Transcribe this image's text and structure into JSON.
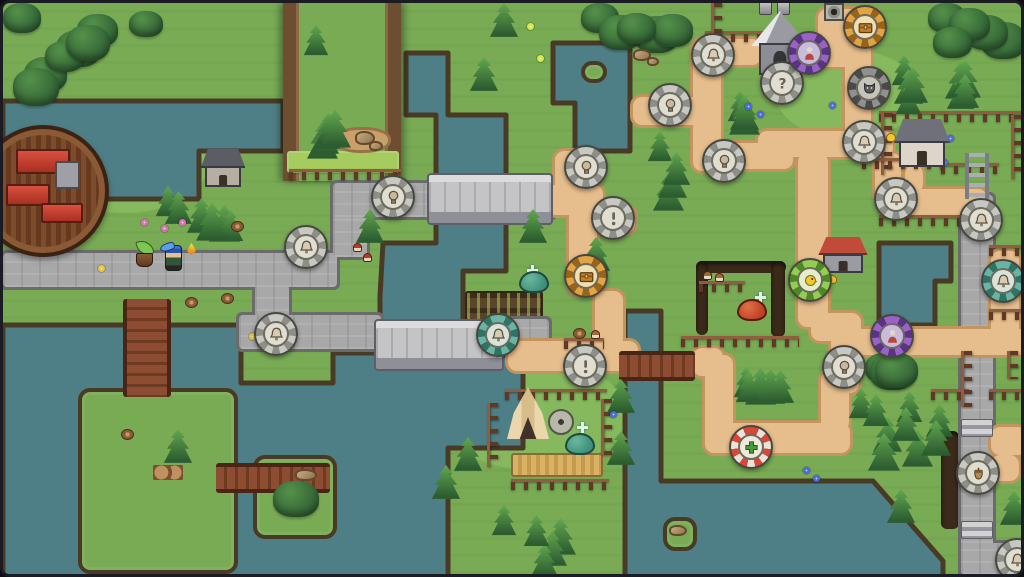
{
  "meta": {
    "width": 1024,
    "height": 577
  },
  "palette": {
    "frame": "#1b1b24",
    "grass": "#79ab55",
    "grass_light": "#86b95e",
    "grass_bright": "#a6cb5e",
    "water": "#4f7f86",
    "cliff": "#493a26",
    "road_fill": "#a8a8a8",
    "road_edge": "#6b6b6b",
    "path_fill": "#e6bd8c",
    "path_edge": "#c2945e",
    "marker_rings": {
      "gray": [
        "#c8c8c2",
        "#8e8e88",
        "#e0ddd1"
      ],
      "orange": [
        "#e2a342",
        "#9a6418",
        "#f0e0b0"
      ],
      "purple": [
        "#9a62c8",
        "#5a3484",
        "#cabade"
      ],
      "teal": [
        "#6ab4a4",
        "#2e7464",
        "#d8e4da"
      ],
      "green": [
        "#94cc54",
        "#4e8a24",
        "#e4eec8"
      ],
      "redwhite": [
        "#d84838",
        "#e8e4da",
        "#efe9dc"
      ],
      "dark": [
        "#909090",
        "#4a4a4a",
        "#c4c4ba"
      ]
    },
    "slime": {
      "teal": [
        "#3f8f7c",
        "#6ab89e",
        "#1e4a40"
      ],
      "red": [
        "#c04024",
        "#e07048",
        "#5a1a0c"
      ]
    }
  },
  "water": [
    {
      "name": "northwest-lake",
      "points": [
        [
          0,
          98
        ],
        [
          280,
          98
        ],
        [
          280,
          148
        ],
        [
          196,
          148
        ],
        [
          196,
          196
        ],
        [
          0,
          196
        ]
      ]
    },
    {
      "name": "central-river-and-south-lake",
      "points": [
        [
          403,
          50
        ],
        [
          445,
          50
        ],
        [
          445,
          112
        ],
        [
          503,
          112
        ],
        [
          503,
          268
        ],
        [
          460,
          268
        ],
        [
          460,
          352
        ],
        [
          520,
          352
        ],
        [
          520,
          445
        ],
        [
          445,
          445
        ],
        [
          445,
          577
        ],
        [
          0,
          577
        ],
        [
          0,
          322
        ],
        [
          238,
          322
        ],
        [
          238,
          380
        ],
        [
          330,
          380
        ],
        [
          330,
          350
        ],
        [
          377,
          350
        ],
        [
          377,
          293
        ],
        [
          380,
          240
        ],
        [
          433,
          240
        ],
        [
          433,
          112
        ],
        [
          403,
          112
        ]
      ]
    },
    {
      "name": "forest-pond",
      "points": [
        [
          550,
          40
        ],
        [
          627,
          40
        ],
        [
          627,
          148
        ],
        [
          572,
          148
        ],
        [
          572,
          100
        ],
        [
          550,
          100
        ]
      ]
    },
    {
      "name": "east-pond",
      "points": [
        [
          876,
          240
        ],
        [
          948,
          240
        ],
        [
          948,
          278
        ],
        [
          932,
          278
        ],
        [
          932,
          322
        ],
        [
          876,
          322
        ]
      ]
    },
    {
      "name": "south-river-and-sea",
      "points": [
        [
          622,
          308
        ],
        [
          658,
          308
        ],
        [
          658,
          478
        ],
        [
          870,
          478
        ],
        [
          940,
          558
        ],
        [
          940,
          577
        ],
        [
          622,
          577
        ]
      ]
    }
  ],
  "islands": [
    {
      "x": 75,
      "y": 385,
      "w": 160,
      "h": 186
    },
    {
      "x": 250,
      "y": 452,
      "w": 84,
      "h": 84
    },
    {
      "x": 578,
      "y": 58,
      "w": 26,
      "h": 22
    },
    {
      "x": 660,
      "y": 514,
      "w": 34,
      "h": 34
    }
  ],
  "plateau": {
    "x": 280,
    "y": 0,
    "w": 118,
    "h": 178
  },
  "roads": [
    [
      0,
      250,
      334,
      34
    ],
    [
      252,
      282,
      34,
      38
    ],
    [
      236,
      312,
      142,
      34
    ],
    [
      330,
      192,
      34,
      62
    ],
    [
      330,
      180,
      222,
      34
    ],
    [
      490,
      316,
      56,
      34
    ],
    [
      958,
      192,
      32,
      360
    ],
    [
      958,
      540,
      66,
      32
    ]
  ],
  "paths": [
    [
      544,
      182,
      56,
      30
    ],
    [
      552,
      148,
      30,
      58
    ],
    [
      630,
      94,
      72,
      28
    ],
    [
      690,
      36,
      28,
      132
    ],
    [
      690,
      140,
      100,
      26
    ],
    [
      755,
      128,
      135,
      26
    ],
    [
      872,
      150,
      26,
      50
    ],
    [
      902,
      162,
      18,
      28
    ],
    [
      884,
      186,
      100,
      26
    ],
    [
      694,
      36,
      64,
      26
    ],
    [
      798,
      36,
      66,
      28
    ],
    [
      766,
      66,
      26,
      30
    ],
    [
      842,
      40,
      26,
      104
    ],
    [
      815,
      6,
      62,
      34
    ],
    [
      566,
      200,
      28,
      92
    ],
    [
      588,
      204,
      44,
      26
    ],
    [
      592,
      288,
      28,
      56
    ],
    [
      505,
      338,
      130,
      30
    ],
    [
      690,
      345,
      30,
      28
    ],
    [
      702,
      352,
      28,
      86
    ],
    [
      702,
      420,
      145,
      30
    ],
    [
      818,
      368,
      28,
      60
    ],
    [
      795,
      150,
      30,
      174
    ],
    [
      808,
      310,
      50,
      28
    ],
    [
      828,
      330,
      28,
      60
    ],
    [
      850,
      326,
      174,
      26
    ],
    [
      988,
      248,
      28,
      100
    ],
    [
      988,
      424,
      36,
      28
    ],
    [
      988,
      452,
      28,
      26
    ]
  ],
  "bridges": [
    {
      "type": "stone",
      "x": 424,
      "y": 170,
      "w": 126,
      "h": 52
    },
    {
      "type": "stone",
      "x": 371,
      "y": 316,
      "w": 130,
      "h": 52
    },
    {
      "type": "wood-v",
      "x": 120,
      "y": 296,
      "w": 48,
      "h": 98
    },
    {
      "type": "wood-h",
      "x": 213,
      "y": 460,
      "w": 114,
      "h": 30
    },
    {
      "type": "wood-h",
      "x": 616,
      "y": 348,
      "w": 76,
      "h": 30
    }
  ],
  "fields": [
    {
      "type": "crops",
      "x": 462,
      "y": 288,
      "w": 78,
      "h": 30
    },
    {
      "type": "wheat",
      "x": 508,
      "y": 450,
      "w": 92,
      "h": 24
    },
    {
      "type": "meadow",
      "x": 284,
      "y": 148,
      "w": 112,
      "h": 22
    },
    {
      "type": "dirt",
      "x": 330,
      "y": 124,
      "w": 58,
      "h": 26
    }
  ],
  "fences": [
    [
      286,
      166,
      112,
      "h"
    ],
    [
      702,
      28,
      62,
      "h"
    ],
    [
      708,
      0,
      34,
      "v"
    ],
    [
      876,
      108,
      146,
      "h"
    ],
    [
      878,
      110,
      62,
      "v"
    ],
    [
      938,
      160,
      58,
      "h"
    ],
    [
      1008,
      112,
      64,
      "v"
    ],
    [
      859,
      155,
      80,
      "h"
    ],
    [
      876,
      212,
      116,
      "h"
    ],
    [
      696,
      278,
      46,
      "h"
    ],
    [
      678,
      333,
      118,
      "h"
    ],
    [
      561,
      335,
      40,
      "h"
    ],
    [
      928,
      386,
      38,
      "h"
    ],
    [
      986,
      386,
      38,
      "h"
    ],
    [
      986,
      242,
      38,
      "h"
    ],
    [
      986,
      306,
      38,
      "h"
    ],
    [
      958,
      348,
      56,
      "v"
    ],
    [
      1004,
      348,
      28,
      "v"
    ],
    [
      502,
      386,
      102,
      "h"
    ],
    [
      484,
      400,
      64,
      "v"
    ],
    [
      598,
      396,
      56,
      "v"
    ],
    [
      508,
      476,
      98,
      "h"
    ]
  ],
  "trenches": [
    [
      693,
      258,
      90,
      12
    ],
    [
      693,
      258,
      12,
      74
    ],
    [
      768,
      258,
      14,
      76
    ],
    [
      938,
      428,
      18,
      98
    ]
  ],
  "forests": [
    {
      "kind": "bush",
      "x": 0,
      "y": 0,
      "w": 115,
      "h": 100,
      "n": 7
    },
    {
      "kind": "bush",
      "x": 578,
      "y": 0,
      "w": 118,
      "h": 44,
      "n": 5
    },
    {
      "kind": "bush",
      "x": 925,
      "y": 0,
      "w": 99,
      "h": 56,
      "n": 5
    },
    {
      "kind": "pine",
      "x": 888,
      "y": 52,
      "w": 134,
      "h": 60,
      "n": 8
    },
    {
      "kind": "pine",
      "x": 644,
      "y": 128,
      "w": 46,
      "h": 84,
      "n": 4
    },
    {
      "kind": "pine",
      "x": 724,
      "y": 88,
      "w": 56,
      "h": 40,
      "n": 3
    },
    {
      "kind": "pine",
      "x": 152,
      "y": 183,
      "w": 105,
      "h": 56,
      "n": 6
    },
    {
      "kind": "pine",
      "x": 300,
      "y": 22,
      "w": 80,
      "h": 130,
      "n": 6
    },
    {
      "kind": "pine",
      "x": 845,
      "y": 385,
      "w": 112,
      "h": 85,
      "n": 9
    },
    {
      "kind": "pine",
      "x": 730,
      "y": 364,
      "w": 72,
      "h": 54,
      "n": 5
    },
    {
      "kind": "pine",
      "x": 488,
      "y": 502,
      "w": 90,
      "h": 72,
      "n": 5
    },
    {
      "kind": "bush",
      "x": 862,
      "y": 350,
      "w": 54,
      "h": 24,
      "n": 3
    }
  ],
  "trees": [
    [
      578,
      234
    ],
    [
      515,
      206
    ],
    [
      352,
      206
    ],
    [
      466,
      54
    ],
    [
      486,
      0
    ],
    [
      603,
      376
    ],
    [
      603,
      428
    ],
    [
      883,
      486
    ],
    [
      996,
      488
    ],
    [
      450,
      434
    ],
    [
      428,
      462
    ],
    [
      160,
      426
    ]
  ],
  "bushes": [
    [
      126,
      8,
      34,
      26
    ],
    [
      270,
      478,
      46,
      36
    ]
  ],
  "buildings": [
    {
      "type": "walled-town",
      "x": -26,
      "y": 122,
      "w": 132,
      "h": 132
    },
    {
      "type": "house",
      "name": "stone-house",
      "x": 200,
      "y": 146,
      "w": 40,
      "h": 38,
      "roof": "#5c5c66",
      "wall": "#b6aea2"
    },
    {
      "type": "chapel",
      "x": 752,
      "y": 8,
      "w": 50,
      "h": 64
    },
    {
      "type": "house",
      "name": "farm-house",
      "x": 894,
      "y": 116,
      "w": 50,
      "h": 48,
      "roof": "#70707a",
      "wall": "#ddd5c9"
    },
    {
      "type": "house",
      "name": "red-roof-house",
      "x": 818,
      "y": 234,
      "w": 44,
      "h": 36,
      "roof": "#c14b38",
      "wall": "#9b9ba3"
    },
    {
      "type": "tent",
      "x": 504,
      "y": 384,
      "w": 42,
      "h": 52
    }
  ],
  "props": [
    {
      "type": "well",
      "x": 821,
      "y": 0
    },
    {
      "type": "statue",
      "x": 756,
      "y": -4
    },
    {
      "type": "statue",
      "x": 774,
      "y": -4
    },
    {
      "type": "millstone",
      "x": 545,
      "y": 406
    },
    {
      "type": "ladder",
      "x": 962,
      "y": 150
    },
    {
      "type": "stairs",
      "x": 958,
      "y": 416
    },
    {
      "type": "stairs",
      "x": 958,
      "y": 518
    },
    {
      "type": "logs",
      "x": 150,
      "y": 462
    },
    {
      "type": "rock",
      "x": 352,
      "y": 128,
      "w": 20,
      "h": 14
    },
    {
      "type": "rock",
      "x": 366,
      "y": 138,
      "w": 14,
      "h": 10
    },
    {
      "type": "rock",
      "x": 630,
      "y": 46,
      "w": 18,
      "h": 12
    },
    {
      "type": "rock",
      "x": 644,
      "y": 54,
      "w": 12,
      "h": 9
    },
    {
      "type": "rock",
      "x": 292,
      "y": 466,
      "w": 22,
      "h": 12
    },
    {
      "type": "rock",
      "x": 666,
      "y": 522,
      "w": 18,
      "h": 11
    },
    {
      "type": "stump",
      "x": 228,
      "y": 218
    },
    {
      "type": "stump",
      "x": 570,
      "y": 325
    },
    {
      "type": "stump",
      "x": 118,
      "y": 426
    },
    {
      "type": "stump",
      "x": 182,
      "y": 294
    },
    {
      "type": "stump",
      "x": 218,
      "y": 290
    },
    {
      "type": "mushroom",
      "x": 350,
      "y": 240,
      "color": "#c03828"
    },
    {
      "type": "mushroom",
      "x": 360,
      "y": 250,
      "color": "#c03828"
    },
    {
      "type": "mushroom",
      "x": 700,
      "y": 268,
      "color": "#a06a3a"
    },
    {
      "type": "mushroom",
      "x": 712,
      "y": 270,
      "color": "#a06a3a"
    },
    {
      "type": "mushroom",
      "x": 588,
      "y": 327,
      "color": "#a06a3a"
    },
    {
      "type": "flower",
      "x": 138,
      "y": 216,
      "color": "#e070b8"
    },
    {
      "type": "flower",
      "x": 158,
      "y": 222,
      "color": "#e070b8"
    },
    {
      "type": "flower",
      "x": 176,
      "y": 216,
      "color": "#e070b8"
    },
    {
      "type": "flower",
      "x": 95,
      "y": 262,
      "color": "#e8c83a"
    },
    {
      "type": "flower",
      "x": 246,
      "y": 330,
      "color": "#e8c83a"
    },
    {
      "type": "flower",
      "x": 524,
      "y": 20,
      "color": "#d8e84a"
    },
    {
      "type": "flower",
      "x": 534,
      "y": 52,
      "color": "#d8e84a"
    },
    {
      "type": "flower",
      "x": 944,
      "y": 132,
      "color": "#4a6ae0"
    },
    {
      "type": "flower",
      "x": 938,
      "y": 156,
      "color": "#4a6ae0"
    },
    {
      "type": "flower",
      "x": 742,
      "y": 100,
      "color": "#4a6ae0"
    },
    {
      "type": "flower",
      "x": 754,
      "y": 108,
      "color": "#4a6ae0"
    },
    {
      "type": "flower",
      "x": 826,
      "y": 99,
      "color": "#4a6ae0"
    },
    {
      "type": "flower",
      "x": 607,
      "y": 408,
      "color": "#4a6ae0"
    },
    {
      "type": "flower",
      "x": 800,
      "y": 464,
      "color": "#4a6ae0"
    },
    {
      "type": "flower",
      "x": 810,
      "y": 472,
      "color": "#4a6ae0"
    },
    {
      "type": "chick",
      "x": 883,
      "y": 130
    },
    {
      "type": "chick",
      "x": 824,
      "y": 272
    },
    {
      "type": "sparkle",
      "x": 524,
      "y": 262
    },
    {
      "type": "sparkle",
      "x": 752,
      "y": 289
    },
    {
      "type": "sparkle",
      "x": 574,
      "y": 419
    }
  ],
  "creatures": [
    {
      "kind": "slime",
      "color": "teal",
      "x": 516,
      "y": 268
    },
    {
      "kind": "slime",
      "color": "red",
      "x": 734,
      "y": 296
    },
    {
      "kind": "slime",
      "color": "teal",
      "x": 562,
      "y": 430
    }
  ],
  "characters": [
    {
      "type": "sprout-companion",
      "x": 132,
      "y": 240
    },
    {
      "type": "player",
      "x": 162,
      "y": 242
    },
    {
      "type": "flame",
      "x": 184,
      "y": 240
    }
  ],
  "markers": [
    {
      "x": 303,
      "y": 244,
      "ring": "gray",
      "icon": "bell-icon"
    },
    {
      "x": 273,
      "y": 331,
      "ring": "gray",
      "icon": "bell-icon"
    },
    {
      "x": 390,
      "y": 194,
      "ring": "gray",
      "icon": "bulb-icon"
    },
    {
      "x": 495,
      "y": 332,
      "ring": "teal",
      "icon": "bell-icon"
    },
    {
      "x": 583,
      "y": 164,
      "ring": "gray",
      "icon": "bulb-icon"
    },
    {
      "x": 583,
      "y": 273,
      "ring": "orange",
      "icon": "chest-icon"
    },
    {
      "x": 582,
      "y": 363,
      "ring": "gray",
      "icon": "exclamation-icon"
    },
    {
      "x": 610,
      "y": 215,
      "ring": "gray",
      "icon": "exclamation-icon"
    },
    {
      "x": 667,
      "y": 102,
      "ring": "gray",
      "icon": "bulb-icon"
    },
    {
      "x": 721,
      "y": 158,
      "ring": "gray",
      "icon": "bulb-icon"
    },
    {
      "x": 710,
      "y": 52,
      "ring": "gray",
      "icon": "bell-icon"
    },
    {
      "x": 779,
      "y": 80,
      "ring": "gray",
      "icon": "question-icon"
    },
    {
      "x": 806,
      "y": 50,
      "ring": "purple",
      "icon": "figure-icon"
    },
    {
      "x": 862,
      "y": 24,
      "ring": "orange",
      "icon": "chest-icon"
    },
    {
      "x": 866,
      "y": 85,
      "ring": "dark",
      "icon": "cat-icon"
    },
    {
      "x": 807,
      "y": 277,
      "ring": "green",
      "icon": "chick-icon"
    },
    {
      "x": 861,
      "y": 139,
      "ring": "gray",
      "icon": "bell-icon"
    },
    {
      "x": 893,
      "y": 196,
      "ring": "gray",
      "icon": "bell-icon"
    },
    {
      "x": 978,
      "y": 217,
      "ring": "gray",
      "icon": "bell-icon"
    },
    {
      "x": 1000,
      "y": 278,
      "ring": "teal",
      "icon": "bell-icon"
    },
    {
      "x": 889,
      "y": 333,
      "ring": "purple",
      "icon": "figure-icon"
    },
    {
      "x": 841,
      "y": 364,
      "ring": "gray",
      "icon": "bulb-icon"
    },
    {
      "x": 748,
      "y": 444,
      "ring": "redwhite",
      "icon": "cross-icon"
    },
    {
      "x": 975,
      "y": 470,
      "ring": "gray",
      "icon": "acorn-icon"
    },
    {
      "x": 1014,
      "y": 557,
      "ring": "gray",
      "icon": "bell-icon"
    }
  ]
}
